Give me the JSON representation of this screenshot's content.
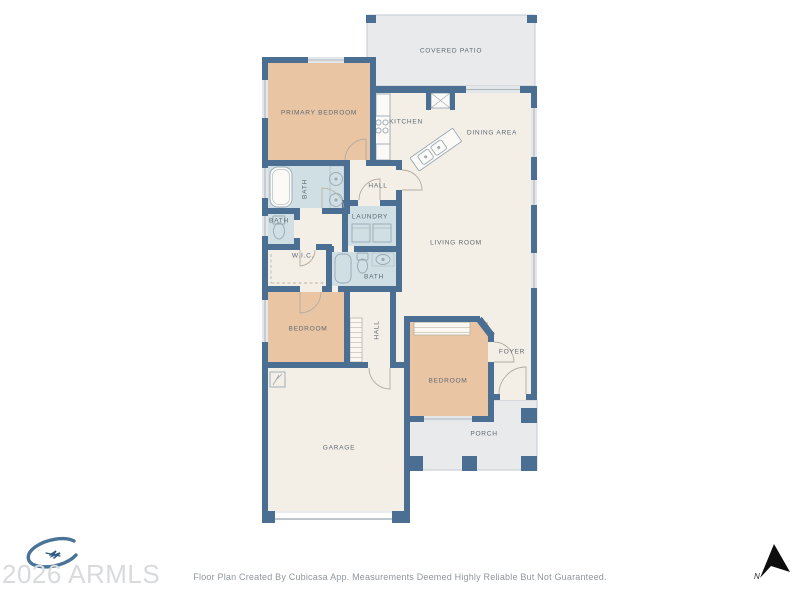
{
  "rooms": {
    "covered_patio": {
      "label": "COVERED PATIO"
    },
    "primary_bedroom": {
      "label": "PRIMARY BEDROOM"
    },
    "kitchen": {
      "label": "KITCHEN"
    },
    "dining_area": {
      "label": "DINING AREA"
    },
    "hall_upper": {
      "label": "HALL"
    },
    "primary_bath": {
      "label": "BATH"
    },
    "bath_small": {
      "label": "BATH"
    },
    "laundry": {
      "label": "LAUNDRY"
    },
    "wic": {
      "label": "W.I.C."
    },
    "bath_second": {
      "label": "BATH"
    },
    "living_room": {
      "label": "LIVING ROOM"
    },
    "bedroom_left": {
      "label": "BEDROOM"
    },
    "hall_lower": {
      "label": "HALL"
    },
    "bedroom_right": {
      "label": "BEDROOM"
    },
    "foyer": {
      "label": "FOYER"
    },
    "porch": {
      "label": "PORCH"
    },
    "garage": {
      "label": "GARAGE"
    }
  },
  "watermark": {
    "text": "2026 ARMLS"
  },
  "compass": {
    "label": "N"
  },
  "footer": {
    "disclaimer": "Floor Plan Created By Cubicasa App. Measurements Deemed Highly Reliable But Not Guaranteed."
  },
  "colors": {
    "wall": "#4a6f92",
    "floor": "#f4efe6",
    "bedroom_fill": "#eac5a4",
    "wet_room_fill": "#cfdfe4",
    "outdoor_fill": "#e9eaeb"
  }
}
